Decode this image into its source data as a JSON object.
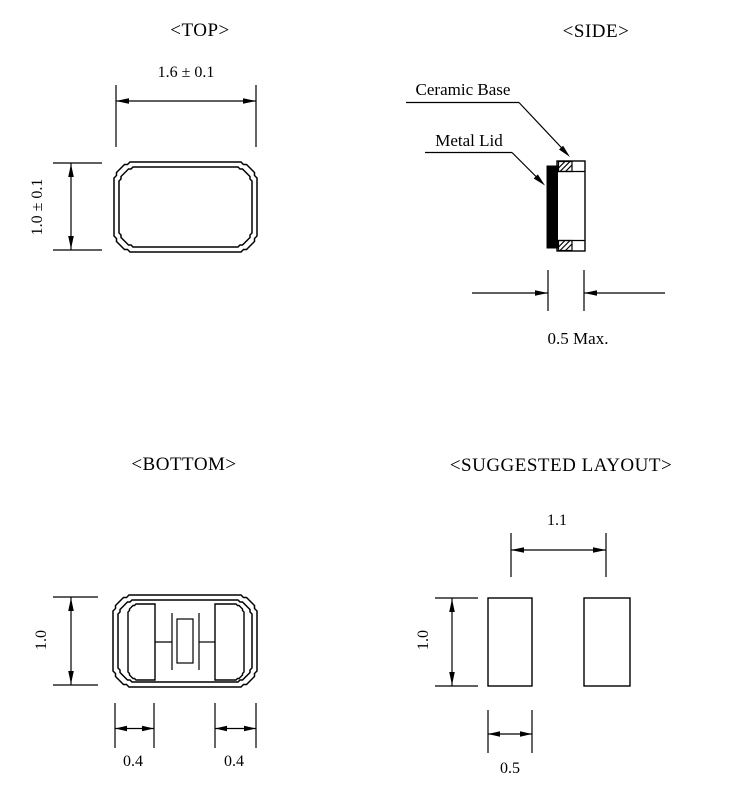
{
  "drawing": {
    "views": {
      "top": {
        "title": "<TOP>",
        "width_dim": "1.6 ± 0.1",
        "height_dim": "1.0 ± 0.1"
      },
      "side": {
        "title": "<SIDE>",
        "ceramic_base_label": "Ceramic Base",
        "metal_lid_label": "Metal Lid",
        "thickness_dim": "0.5 Max."
      },
      "bottom": {
        "title": "<BOTTOM>",
        "height_dim": "1.0",
        "left_pad_dim": "0.4",
        "right_pad_dim": "0.4"
      },
      "suggested_layout": {
        "title": "<SUGGESTED LAYOUT>",
        "pad_pitch_dim": "1.1",
        "pad_height_dim": "1.0",
        "pad_width_dim": "0.5"
      }
    },
    "colors": {
      "line": "#000000",
      "background": "#ffffff"
    }
  }
}
